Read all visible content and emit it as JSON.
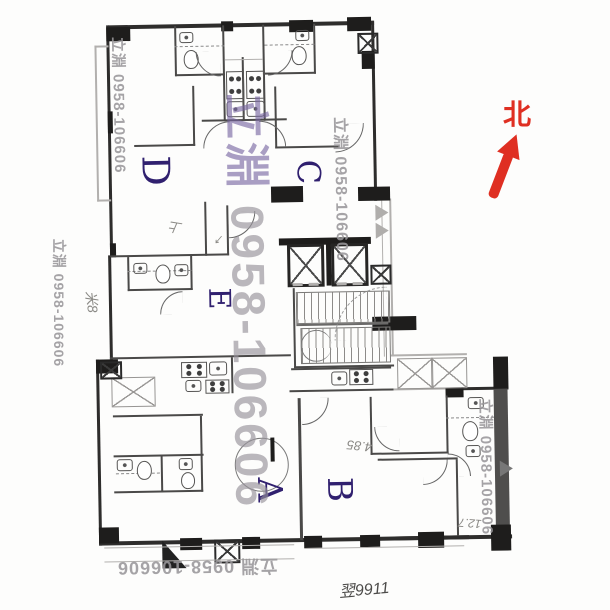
{
  "document": {
    "kind": "scanned apartment floor plan"
  },
  "north": {
    "label": "北",
    "color": "#df2f22"
  },
  "units": {
    "d": "D",
    "c": "C",
    "e": "E",
    "a": "A",
    "b": "B"
  },
  "watermark": {
    "brand": "立淵",
    "phone": "0958-106606",
    "full": "立淵 0958-106606",
    "gray": "#9896",
    "purple": "#7664a0"
  },
  "annotations": {
    "left_margin": "米8",
    "room_note": "上",
    "arrow_note": "↙",
    "area_b": "4.85",
    "area_b2": "12.7",
    "bottom_note": "翌9911"
  },
  "colors": {
    "unit_label": "#30206f",
    "pencil": "#8b8a86"
  }
}
